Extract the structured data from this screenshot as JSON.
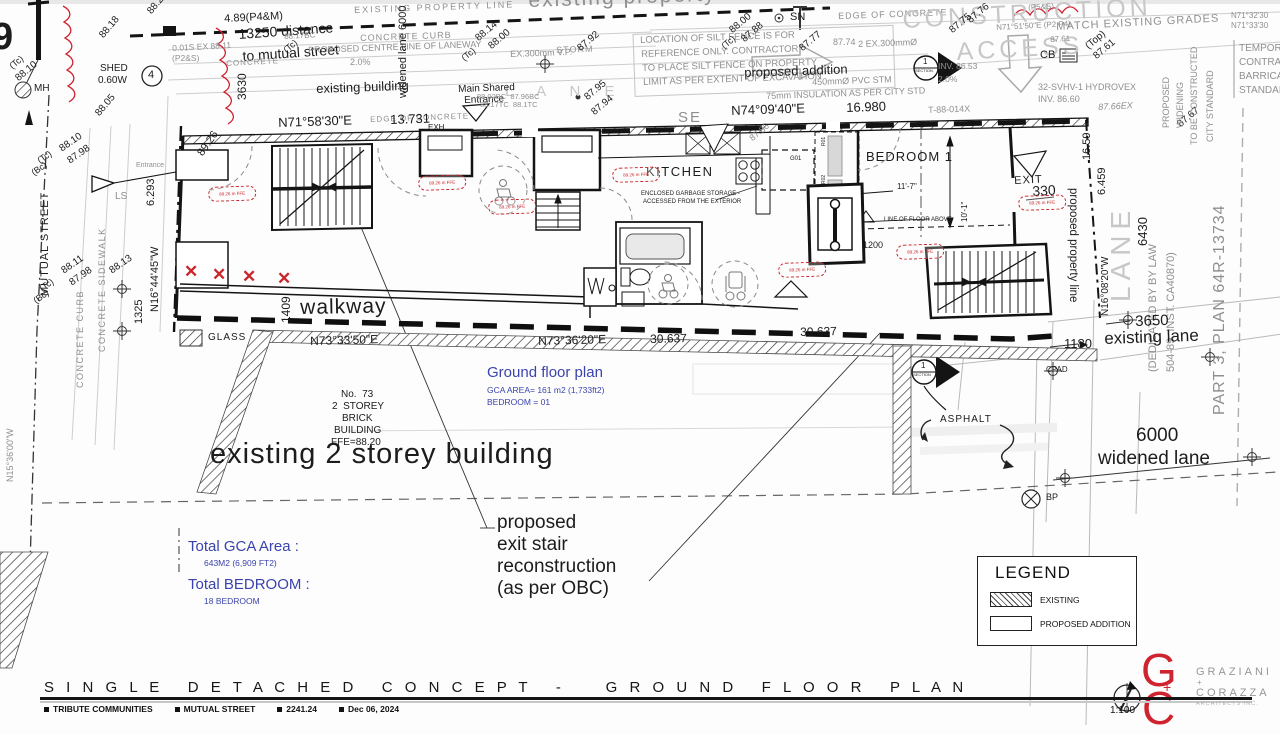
{
  "title_block": {
    "title": "S I N G L E   D E T A C H E D   C O N C E P T   -     G R O U N D   F L O O R   P L A N",
    "tags": [
      "TRIBUTE COMMUNITIES",
      "MUTUAL STREET",
      "2241.24",
      "Dec 06, 2024"
    ],
    "scale": "1:100"
  },
  "logo": {
    "line1": "GRAZIANI",
    "plus": "+",
    "line2": "CORAZZA",
    "line3": "ARCHITECTS INC."
  },
  "legend": {
    "title": "LEGEND",
    "items": [
      {
        "label": "EXISTING",
        "swatch": "hatched"
      },
      {
        "label": "PROPOSED ADDITION",
        "swatch": "plain"
      }
    ]
  },
  "notes": {
    "ground_floor": {
      "title": "Ground floor plan",
      "line1": "GCA AREA= 161 m2 (1,733ft2)",
      "line2": "BEDROOM = 01"
    },
    "totals": {
      "gca_label": "Total GCA Area :",
      "gca_value": "643M2 (6,909 FT2)",
      "bed_label": "Total BEDROOM :",
      "bed_value": "18 BEDROOM"
    }
  },
  "colors": {
    "k": "#1c1c1c",
    "g": "#8f8f8f",
    "l": "#c7c7c7",
    "r": "#cf2330",
    "b": "#3a43ad"
  },
  "red_marks": {
    "ffe_text": "89.26 m FFE",
    "ffe_positions": [
      [
        208,
        187
      ],
      [
        418,
        176
      ],
      [
        488,
        200
      ],
      [
        612,
        168
      ],
      [
        778,
        263
      ],
      [
        896,
        245
      ],
      [
        1018,
        196
      ]
    ],
    "x_positions": [
      [
        184,
        263
      ],
      [
        212,
        266
      ],
      [
        242,
        268
      ],
      [
        277,
        270
      ]
    ]
  },
  "labels": [
    {
      "t": "9",
      "x": -8,
      "y": 18,
      "s": 38,
      "w": 700,
      "n": "cutoff-glyph"
    },
    {
      "t": "(Tc)",
      "x": 8,
      "y": 64,
      "s": 9,
      "r": -40
    },
    {
      "t": "88.10",
      "x": 14,
      "y": 76,
      "s": 10,
      "r": -40
    },
    {
      "t": "MH",
      "x": 34,
      "y": 84,
      "s": 10,
      "n": "label-manhole"
    },
    {
      "t": "88.20",
      "x": 146,
      "y": 10,
      "s": 10,
      "r": -50
    },
    {
      "t": "88.18",
      "x": 98,
      "y": 34,
      "s": 10,
      "r": -50
    },
    {
      "t": "SHED",
      "x": 100,
      "y": 64,
      "s": 10,
      "n": "label-shed"
    },
    {
      "t": "0.60W",
      "x": 98,
      "y": 76,
      "s": 10
    },
    {
      "t": "88.05",
      "x": 94,
      "y": 112,
      "s": 10,
      "r": -50
    },
    {
      "t": "4",
      "x": 148,
      "y": 70,
      "s": 11,
      "n": "survey-point-4"
    },
    {
      "t": "4.89(P4&M)",
      "x": 224,
      "y": 14,
      "s": 11,
      "r": -3
    },
    {
      "t": "13250 distance",
      "x": 238,
      "y": 27,
      "s": 14,
      "r": -4,
      "n": "label-13250-distance"
    },
    {
      "t": "to mutual street",
      "x": 242,
      "y": 49,
      "s": 14,
      "r": -4
    },
    {
      "t": "0.01S EX 88.11",
      "x": 172,
      "y": 44,
      "s": 8.5,
      "c": "g",
      "r": -3
    },
    {
      "t": "(P2&S)",
      "x": 172,
      "y": 54,
      "s": 8.5,
      "c": "g"
    },
    {
      "t": "CONCRETE",
      "x": 226,
      "y": 60,
      "s": 8,
      "c": "g",
      "r": -3,
      "ls": 1
    },
    {
      "t": "3630",
      "x": 236,
      "y": 100,
      "s": 12,
      "r": -90
    },
    {
      "t": "88.17BC",
      "x": 284,
      "y": 33,
      "s": 8,
      "c": "g",
      "r": -3
    },
    {
      "t": "(Tc)",
      "x": 282,
      "y": 48,
      "s": 9,
      "r": -40
    },
    {
      "t": "2.0%",
      "x": 350,
      "y": 58,
      "s": 9,
      "c": "g"
    },
    {
      "t": "(Tc)",
      "x": 36,
      "y": 158,
      "s": 9,
      "r": -35
    },
    {
      "t": "(Bc)",
      "x": 30,
      "y": 170,
      "s": 9,
      "r": -35
    },
    {
      "t": "88.10",
      "x": 58,
      "y": 146,
      "s": 10,
      "r": -35
    },
    {
      "t": "87.98",
      "x": 66,
      "y": 158,
      "s": 10,
      "r": -35
    },
    {
      "t": "MUTUAL STREET",
      "x": 40,
      "y": 296,
      "s": 11,
      "r": -90,
      "ls": 1,
      "n": "label-mutual-street"
    },
    {
      "t": "(Tc)",
      "x": 38,
      "y": 286,
      "s": 9,
      "r": -35
    },
    {
      "t": "(Bc)",
      "x": 32,
      "y": 298,
      "s": 9,
      "r": -35
    },
    {
      "t": "88.11",
      "x": 60,
      "y": 268,
      "s": 10,
      "r": -35
    },
    {
      "t": "87.98",
      "x": 68,
      "y": 280,
      "s": 10,
      "r": -35
    },
    {
      "t": "CONCRETE CURB",
      "x": 76,
      "y": 388,
      "s": 9,
      "c": "g",
      "r": -90,
      "ls": 1.5,
      "n": "label-concrete-curb"
    },
    {
      "t": "CONCRETE SIDEWALK",
      "x": 98,
      "y": 352,
      "s": 9,
      "c": "g",
      "r": -90,
      "ls": 1.5,
      "n": "label-concrete-sidewalk"
    },
    {
      "t": "LS",
      "x": 115,
      "y": 192,
      "s": 10,
      "c": "g"
    },
    {
      "t": "88.13",
      "x": 108,
      "y": 268,
      "s": 10,
      "r": -35
    },
    {
      "t": "1325",
      "x": 134,
      "y": 324,
      "s": 11,
      "r": -90
    },
    {
      "t": "N16°44'45\"W",
      "x": 150,
      "y": 312,
      "s": 11,
      "r": -90,
      "n": "bearing-n16-44-45"
    },
    {
      "t": "6.293",
      "x": 146,
      "y": 206,
      "s": 11,
      "r": -90
    },
    {
      "t": "N15°36'00\"W",
      "x": 6,
      "y": 482,
      "s": 9,
      "c": "g",
      "r": -90,
      "n": "bearing-n15-36-00"
    },
    {
      "t": "89.26",
      "x": 196,
      "y": 152,
      "s": 11,
      "r": -55
    },
    {
      "t": "Entrance",
      "x": 136,
      "y": 162,
      "s": 7,
      "c": "g"
    },
    {
      "t": "EXISTING PROPERTY LINE",
      "x": 354,
      "y": 6,
      "s": 9,
      "c": "g",
      "r": -2,
      "ls": 2,
      "n": "label-existing-property-line"
    },
    {
      "t": "existing property line",
      "x": 528,
      "y": -10,
      "s": 21,
      "c": "g",
      "r": -2,
      "ls": 2,
      "n": "ghost-existing-property-line"
    },
    {
      "t": "CONCRETE CURB",
      "x": 360,
      "y": 34,
      "s": 9,
      "c": "g",
      "r": -2,
      "ls": 1
    },
    {
      "t": "PROPOSED CENTRE LINE OF LANEWAY",
      "x": 308,
      "y": 46,
      "s": 9,
      "c": "g",
      "r": -2,
      "n": "label-centre-line-laneway"
    },
    {
      "t": "6000",
      "x": 398,
      "y": 30,
      "s": 11,
      "r": -90
    },
    {
      "t": "widened lane",
      "x": 398,
      "y": 98,
      "s": 11,
      "r": -90
    },
    {
      "t": "existing building",
      "x": 316,
      "y": 82,
      "s": 13,
      "r": -2,
      "n": "label-existing-building"
    },
    {
      "t": "L A N E",
      "x": 505,
      "y": 84,
      "s": 15,
      "c": "l",
      "ls": 10,
      "n": "ghost-lane-top"
    },
    {
      "t": "Main Shared",
      "x": 458,
      "y": 85,
      "s": 10,
      "r": -2,
      "n": "label-main-shared-entrance"
    },
    {
      "t": "Entrance",
      "x": 464,
      "y": 96,
      "s": 10,
      "r": -2
    },
    {
      "t": "(Tc)",
      "x": 460,
      "y": 56,
      "s": 9,
      "r": -40
    },
    {
      "t": "88.14",
      "x": 474,
      "y": 36,
      "s": 10,
      "r": -40
    },
    {
      "t": "88.00",
      "x": 487,
      "y": 44,
      "s": 10,
      "r": -40
    },
    {
      "t": "EX.300mm V.P.",
      "x": 510,
      "y": 50,
      "s": 9,
      "c": "g",
      "r": -2
    },
    {
      "t": "STORM",
      "x": 556,
      "y": 46,
      "s": 9,
      "c": "g",
      "r": -2,
      "ls": 1
    },
    {
      "t": "87.92",
      "x": 576,
      "y": 46,
      "s": 10,
      "r": -40
    },
    {
      "t": "88.02BC  87.96BC",
      "x": 477,
      "y": 93,
      "s": 7.5,
      "c": "g"
    },
    {
      "t": "88.17TC  88.1TC",
      "x": 480,
      "y": 101,
      "s": 7.5,
      "c": "g"
    },
    {
      "t": "87.95",
      "x": 583,
      "y": 95,
      "s": 10,
      "r": -40
    },
    {
      "t": "87.94",
      "x": 590,
      "y": 110,
      "s": 10,
      "r": -40
    },
    {
      "t": "EDGE OF CONCRETE",
      "x": 370,
      "y": 116,
      "s": 8,
      "c": "g",
      "r": -2,
      "ls": 1
    },
    {
      "t": "N71°58'30\"E",
      "x": 278,
      "y": 116,
      "s": 13,
      "r": -2,
      "n": "bearing-n71-58-30"
    },
    {
      "t": "13.731",
      "x": 390,
      "y": 113,
      "s": 13,
      "r": -2
    },
    {
      "t": "LOCATION OF SILT FENCE IS FOR",
      "x": 640,
      "y": 36,
      "s": 9.5,
      "c": "g",
      "r": -2,
      "n": "silt-fence-note"
    },
    {
      "t": "REFERENCE ONLY. CONTRACTOR",
      "x": 641,
      "y": 50,
      "s": 9.5,
      "c": "g",
      "r": -2
    },
    {
      "t": "TO PLACE SILT FENCE ON PROPERTY",
      "x": 642,
      "y": 64,
      "s": 9.5,
      "c": "g",
      "r": -2
    },
    {
      "t": "LIMIT AS PER EXTENT OF EXCAVATION",
      "x": 643,
      "y": 78,
      "s": 9.5,
      "c": "g",
      "r": -2
    },
    {
      "t": "proposed addition",
      "x": 744,
      "y": 66,
      "s": 13,
      "r": -2,
      "n": "label-proposed-addition"
    },
    {
      "t": "SN",
      "x": 790,
      "y": 12,
      "s": 11
    },
    {
      "t": "EDGE OF CONCRETE",
      "x": 838,
      "y": 12,
      "s": 9,
      "c": "g",
      "r": -2,
      "ls": 1
    },
    {
      "t": "(Tc)",
      "x": 720,
      "y": 44,
      "s": 9,
      "r": -40
    },
    {
      "t": "88.00",
      "x": 728,
      "y": 28,
      "s": 10,
      "r": -40
    },
    {
      "t": "87.88",
      "x": 740,
      "y": 37,
      "s": 10,
      "r": -40
    },
    {
      "t": "87.77",
      "x": 798,
      "y": 46,
      "s": 10,
      "r": -40
    },
    {
      "t": "87.74",
      "x": 833,
      "y": 38,
      "s": 9,
      "c": "g"
    },
    {
      "t": "2 EX.300mmØ",
      "x": 858,
      "y": 40,
      "s": 9,
      "c": "g",
      "r": -2
    },
    {
      "t": "450mmØ PVC STM",
      "x": 812,
      "y": 78,
      "s": 9,
      "c": "g",
      "r": -2
    },
    {
      "t": "75mm INSULATION AS PER CITY STD",
      "x": 766,
      "y": 92,
      "s": 9,
      "c": "g",
      "r": -2
    },
    {
      "t": "N74°09'40\"E",
      "x": 731,
      "y": 104,
      "s": 13,
      "r": -2,
      "n": "bearing-n74-09-40"
    },
    {
      "t": "16.980",
      "x": 846,
      "y": 101,
      "s": 13,
      "r": -2
    },
    {
      "t": "SE",
      "x": 678,
      "y": 110,
      "s": 15,
      "c": "g",
      "ls": 2
    },
    {
      "t": "T-88-014X",
      "x": 928,
      "y": 106,
      "s": 9,
      "c": "g",
      "r": -2
    },
    {
      "t": "CONSTRUCTION",
      "x": 902,
      "y": 8,
      "s": 25,
      "c": "l",
      "r": -3,
      "ls": 4,
      "n": "ghost-construction-access"
    },
    {
      "t": "ACCESS",
      "x": 956,
      "y": 40,
      "s": 25,
      "c": "l",
      "r": -3,
      "ls": 4
    },
    {
      "t": "87.75",
      "x": 948,
      "y": 28,
      "s": 10,
      "r": -40
    },
    {
      "t": "87.76",
      "x": 966,
      "y": 18,
      "s": 10,
      "r": -40
    },
    {
      "t": "INV. 86.53",
      "x": 938,
      "y": 62,
      "s": 8.5,
      "c": "g"
    },
    {
      "t": "2.0%",
      "x": 938,
      "y": 75,
      "s": 8.5,
      "c": "g"
    },
    {
      "t": "(P5&S)",
      "x": 1028,
      "y": 4,
      "s": 8,
      "c": "g",
      "r": -3
    },
    {
      "t": "N71°51'50\"E (P2,P4)",
      "x": 996,
      "y": 24,
      "s": 8,
      "c": "g",
      "r": -3
    },
    {
      "t": "87.61",
      "x": 1050,
      "y": 36,
      "s": 8,
      "c": "g",
      "r": -3
    },
    {
      "t": "CB",
      "x": 1040,
      "y": 50,
      "s": 11,
      "n": "label-catch-basin"
    },
    {
      "t": "MATCH EXISTING GRADES",
      "x": 1056,
      "y": 22,
      "s": 11,
      "c": "g",
      "r": -3,
      "ls": 1,
      "n": "label-match-existing-grades"
    },
    {
      "t": "(Top)",
      "x": 1084,
      "y": 44,
      "s": 10,
      "r": -40
    },
    {
      "t": "87.61",
      "x": 1092,
      "y": 54,
      "s": 10,
      "r": -40
    },
    {
      "t": "N71°32'30",
      "x": 1231,
      "y": 12,
      "s": 8,
      "c": "g"
    },
    {
      "t": "N71°33'30",
      "x": 1231,
      "y": 22,
      "s": 8,
      "c": "g"
    },
    {
      "t": "32-SVHV-1 HYDROVEX",
      "x": 1038,
      "y": 83,
      "s": 9,
      "c": "g",
      "n": "label-hydrovex"
    },
    {
      "t": "INV. 86.60",
      "x": 1038,
      "y": 95,
      "s": 9,
      "c": "g"
    },
    {
      "t": "87.66EX",
      "x": 1098,
      "y": 103,
      "s": 9,
      "c": "g",
      "r": -3,
      "i": 1
    },
    {
      "t": "87.67",
      "x": 1176,
      "y": 122,
      "s": 10,
      "r": -40
    },
    {
      "t": "TEMPORARY",
      "x": 1239,
      "y": 44,
      "s": 10,
      "c": "g"
    },
    {
      "t": "CONTRACTOR",
      "x": 1239,
      "y": 58,
      "s": 10,
      "c": "g"
    },
    {
      "t": "BARRICADE",
      "x": 1239,
      "y": 72,
      "s": 10,
      "c": "g"
    },
    {
      "t": "STANDARD",
      "x": 1239,
      "y": 86,
      "s": 10,
      "c": "g"
    },
    {
      "t": "PROPOSED",
      "x": 1162,
      "y": 128,
      "s": 9,
      "c": "g",
      "r": -90
    },
    {
      "t": "WIDENING",
      "x": 1176,
      "y": 128,
      "s": 9,
      "c": "g",
      "r": -90
    },
    {
      "t": "TO BE CONSTRUCTED",
      "x": 1190,
      "y": 145,
      "s": 9,
      "c": "g",
      "r": -90
    },
    {
      "t": "CITY STANDARD",
      "x": 1206,
      "y": 142,
      "s": 9,
      "c": "g",
      "r": -90
    },
    {
      "t": "EXH",
      "x": 428,
      "y": 124,
      "s": 8,
      "n": "label-exhaust-shaft"
    },
    {
      "t": "KITCHEN",
      "x": 646,
      "y": 165,
      "s": 13,
      "ls": 1.5,
      "n": "label-kitchen"
    },
    {
      "t": "ENCLOSED GARBAGE STORAGE -",
      "x": 641,
      "y": 191,
      "s": 6,
      "n": "garbage-storage-note"
    },
    {
      "t": "ACCESSED FROM THE EXTERIOR",
      "x": 643,
      "y": 199,
      "s": 6
    },
    {
      "t": "G01",
      "x": 790,
      "y": 156,
      "s": 6
    },
    {
      "t": "R01",
      "x": 822,
      "y": 146,
      "s": 5,
      "r": -90
    },
    {
      "t": "R02",
      "x": 822,
      "y": 184,
      "s": 5,
      "r": -90
    },
    {
      "t": "87.86",
      "x": 748,
      "y": 136,
      "s": 9,
      "c": "g",
      "r": -40
    },
    {
      "t": "BEDROOM 1",
      "x": 866,
      "y": 150,
      "s": 13,
      "ls": 1,
      "n": "label-bedroom-1"
    },
    {
      "t": "11'-7\"",
      "x": 897,
      "y": 183,
      "s": 8
    },
    {
      "t": "10'-1\"",
      "x": 961,
      "y": 222,
      "s": 8,
      "r": -90
    },
    {
      "t": "LINE OF FLOOR ABOVE",
      "x": 884,
      "y": 217,
      "s": 6,
      "n": "label-line-of-floor-above"
    },
    {
      "t": "1200",
      "x": 863,
      "y": 241,
      "s": 9
    },
    {
      "t": "EXIT",
      "x": 1014,
      "y": 176,
      "s": 11,
      "r": -3,
      "ls": 1,
      "n": "label-exit"
    },
    {
      "t": "330",
      "x": 1032,
      "y": 184,
      "s": 14,
      "r": -3
    },
    {
      "t": "proposed property line",
      "x": 1078,
      "y": 188,
      "s": 11.5,
      "r": 90,
      "n": "label-proposed-property-line"
    },
    {
      "t": "16.59",
      "x": 1082,
      "y": 160,
      "s": 11,
      "r": -90
    },
    {
      "t": "6.459",
      "x": 1097,
      "y": 195,
      "s": 11,
      "r": -90
    },
    {
      "t": "6430",
      "x": 1136,
      "y": 246,
      "s": 13,
      "r": -90
    },
    {
      "t": "N16°08'20\"W",
      "x": 1101,
      "y": 316,
      "s": 10,
      "r": -90,
      "n": "bearing-n16-08-20"
    },
    {
      "t": "LANE",
      "x": 1107,
      "y": 302,
      "s": 28,
      "c": "l",
      "r": -90,
      "ls": 6,
      "n": "ghost-lane-right"
    },
    {
      "t": "(DEDICATED BY BY LAW",
      "x": 1148,
      "y": 372,
      "s": 11,
      "c": "g",
      "r": -90,
      "n": "label-dedicated-bylaw"
    },
    {
      "t": "504-89, INST. CA40870)",
      "x": 1166,
      "y": 372,
      "s": 11,
      "c": "g",
      "r": -90
    },
    {
      "t": "PART 3, PLAN 64R-13734",
      "x": 1212,
      "y": 415,
      "s": 16,
      "c": "g",
      "r": -90,
      "ls": 1,
      "n": "label-part3-plan"
    },
    {
      "t": "3650",
      "x": 1135,
      "y": 314,
      "s": 15,
      "r": -2
    },
    {
      "t": "existing lane",
      "x": 1104,
      "y": 330,
      "s": 17,
      "r": -2,
      "n": "label-existing-lane"
    },
    {
      "t": "1180",
      "x": 1064,
      "y": 337,
      "s": 13
    },
    {
      "t": "CPAD",
      "x": 1046,
      "y": 366,
      "s": 8
    },
    {
      "t": "1409",
      "x": 280,
      "y": 323,
      "s": 12,
      "r": -90
    },
    {
      "t": "walkway",
      "x": 300,
      "y": 297,
      "s": 21,
      "r": -1,
      "ls": 1,
      "n": "label-walkway"
    },
    {
      "t": "GLASS",
      "x": 208,
      "y": 333,
      "s": 10,
      "ls": 1,
      "n": "label-glass"
    },
    {
      "t": "N73°33'50\"E",
      "x": 310,
      "y": 335,
      "s": 12,
      "r": -1.5,
      "n": "bearing-n73-33-50"
    },
    {
      "t": "N73°36'20\"E",
      "x": 538,
      "y": 335,
      "s": 12,
      "r": -1.5,
      "n": "bearing-n73-36-20"
    },
    {
      "t": "30.637",
      "x": 650,
      "y": 333,
      "s": 12,
      "r": -1.5
    },
    {
      "t": "30.637",
      "x": 800,
      "y": 326,
      "s": 12,
      "r": -1.5
    },
    {
      "t": "No.  73",
      "x": 341,
      "y": 390,
      "s": 10,
      "n": "label-no-73"
    },
    {
      "t": "2  STOREY",
      "x": 332,
      "y": 402,
      "s": 10
    },
    {
      "t": "BRICK",
      "x": 342,
      "y": 414,
      "s": 10
    },
    {
      "t": "BUILDING",
      "x": 334,
      "y": 426,
      "s": 10
    },
    {
      "t": "FFE=88.20",
      "x": 331,
      "y": 438,
      "s": 10
    },
    {
      "t": "existing 2 storey building",
      "x": 210,
      "y": 440,
      "s": 29,
      "ls": 1,
      "n": "label-existing-2-storey-building"
    },
    {
      "t": "ASPHALT",
      "x": 940,
      "y": 415,
      "s": 10,
      "ls": 1,
      "n": "label-asphalt"
    },
    {
      "t": "6000",
      "x": 1136,
      "y": 426,
      "s": 19,
      "n": "label-6000"
    },
    {
      "t": "widened lane",
      "x": 1098,
      "y": 449,
      "s": 19,
      "n": "label-widened-lane"
    },
    {
      "t": "BP",
      "x": 1046,
      "y": 493,
      "s": 9
    },
    {
      "t": "proposed",
      "x": 497,
      "y": 513,
      "s": 19,
      "n": "note-exit-stair"
    },
    {
      "t": "exit stair",
      "x": 497,
      "y": 535,
      "s": 19
    },
    {
      "t": "reconstruction",
      "x": 497,
      "y": 557,
      "s": 19
    },
    {
      "t": "(as per OBC)",
      "x": 497,
      "y": 579,
      "s": 19
    },
    {
      "t": "1",
      "x": 923,
      "y": 58,
      "s": 8,
      "n": "section-marker-1"
    },
    {
      "t": "SECTION",
      "x": 915,
      "y": 69,
      "s": 4
    },
    {
      "t": "1",
      "x": 921,
      "y": 362,
      "s": 8,
      "n": "section-marker-2"
    },
    {
      "t": "SECTION",
      "x": 913,
      "y": 373,
      "s": 4
    },
    {
      "t": "G",
      "x": 1141,
      "y": 647,
      "s": 46,
      "c": "r",
      "w": 300,
      "n": "logo-g"
    },
    {
      "t": "C",
      "x": 1142,
      "y": 685,
      "s": 46,
      "c": "r",
      "w": 300,
      "n": "logo-c"
    },
    {
      "t": "+",
      "x": 1163,
      "y": 680,
      "s": 14,
      "c": "r",
      "n": "logo-plus"
    }
  ]
}
